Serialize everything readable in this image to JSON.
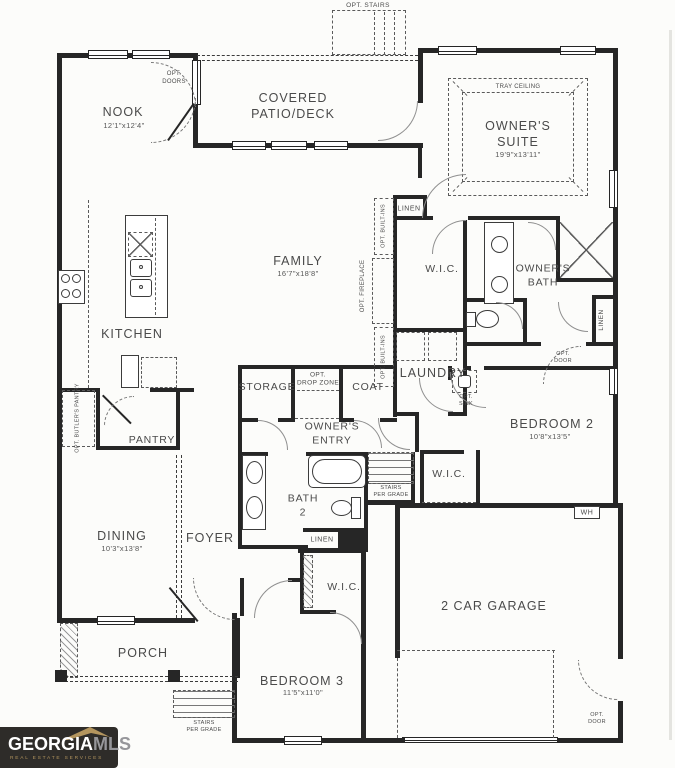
{
  "logo": {
    "brand_primary": "GEORGIA",
    "brand_secondary": "MLS",
    "tagline": "REAL ESTATE SERVICES",
    "colors": {
      "background": "#2e2c29",
      "primary": "#ffffff",
      "secondary": "#96969a",
      "accent": "#b3955e"
    }
  },
  "rooms": {
    "nook": {
      "name": "NOOK",
      "dims": "12'1\"x12'4\""
    },
    "covered_patio": {
      "line1": "COVERED",
      "line2": "PATIO/DECK"
    },
    "owners_suite": {
      "line1": "OWNER'S",
      "line2": "SUITE",
      "dims": "19'9\"x13'11\"",
      "ceiling_note": "TRAY CEILING"
    },
    "family": {
      "name": "FAMILY",
      "dims": "16'7\"x18'8\""
    },
    "kitchen": {
      "name": "KITCHEN"
    },
    "owners_wic": {
      "name": "W.I.C."
    },
    "owners_bath": {
      "line1": "OWNER'S",
      "line2": "BATH"
    },
    "laundry": {
      "name": "LAUNDRY"
    },
    "storage": {
      "name": "STORAGE"
    },
    "coat": {
      "name": "COAT"
    },
    "owners_entry": {
      "line1": "OWNER'S",
      "line2": "ENTRY"
    },
    "bedroom2": {
      "name": "BEDROOM 2",
      "dims": "10'8\"x13'5\""
    },
    "bedroom2_wic": {
      "name": "W.I.C."
    },
    "pantry": {
      "name": "PANTRY"
    },
    "bath2": {
      "line1": "BATH",
      "line2": "2"
    },
    "dining": {
      "name": "DINING",
      "dims": "10'3\"x13'8\""
    },
    "foyer": {
      "name": "FOYER"
    },
    "porch": {
      "name": "PORCH"
    },
    "bedroom3": {
      "name": "BEDROOM 3",
      "dims": "11'5\"x11'0\""
    },
    "bedroom3_wic": {
      "name": "W.I.C."
    },
    "garage": {
      "name": "2 CAR GARAGE"
    }
  },
  "annotations": {
    "opt_stairs": "OPT. STAIRS",
    "opt_doors": {
      "line1": "OPT.",
      "line2": "DOORS"
    },
    "linen_hall": "LINEN",
    "linen_owners_bath": "LINEN",
    "linen_bath2": "LINEN",
    "opt_fireplace": "OPT. FIREPLACE",
    "opt_builtins_upper": "OPT. BUILT-INS",
    "opt_builtins_lower": "OPT. BUILT-INS",
    "opt_drop_zone": {
      "line1": "OPT.",
      "line2": "DROP ZONE"
    },
    "opt_sink": {
      "line1": "OPT.",
      "line2": "SINK"
    },
    "opt_butlers_pantry": "OPT. BUTLER'S PANTRY",
    "opt_door_owners_bath": {
      "line1": "OPT.",
      "line2": "DOOR"
    },
    "opt_door_garage": {
      "line1": "OPT.",
      "line2": "DOOR"
    },
    "stairs_per_grade_interior": {
      "line1": "STAIRS",
      "line2": "PER GRADE"
    },
    "stairs_per_grade_porch": {
      "line1": "STAIRS",
      "line2": "PER GRADE"
    },
    "water_heater": "WH"
  }
}
